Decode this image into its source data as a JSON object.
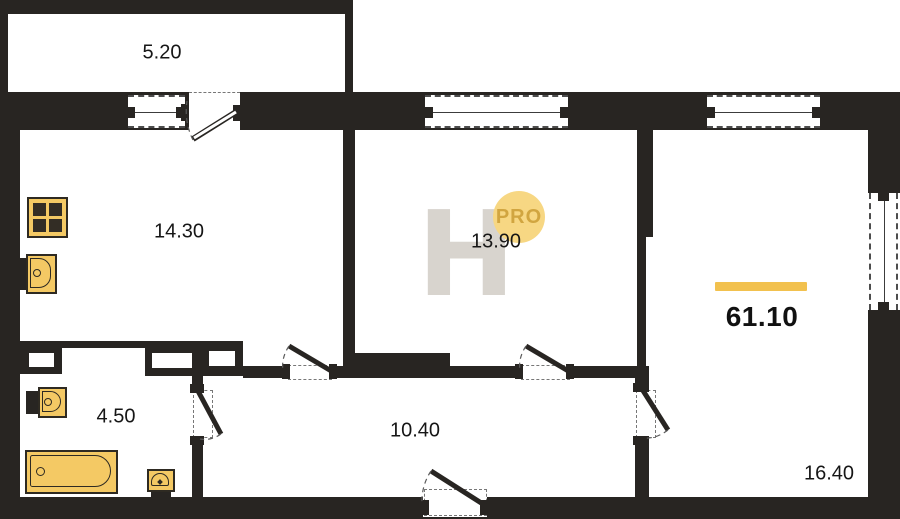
{
  "floorplan": {
    "total_area": "61.10",
    "rooms": {
      "balcony": "5.20",
      "kitchen": "14.30",
      "room": "13.90",
      "bathroom": "4.50",
      "hallway": "10.40",
      "living_room": "16.40"
    },
    "watermark": {
      "letter": "H",
      "badge": "PRO"
    },
    "colors": {
      "wall": "#282522",
      "fixture_fill": "#F4C964",
      "fixture_stroke": "#2e2a22",
      "accent_bar": "#F2C14E",
      "badge_fill": "#F7D783",
      "badge_text": "#C7982F",
      "watermark_grey": "#D8D4CE"
    }
  }
}
